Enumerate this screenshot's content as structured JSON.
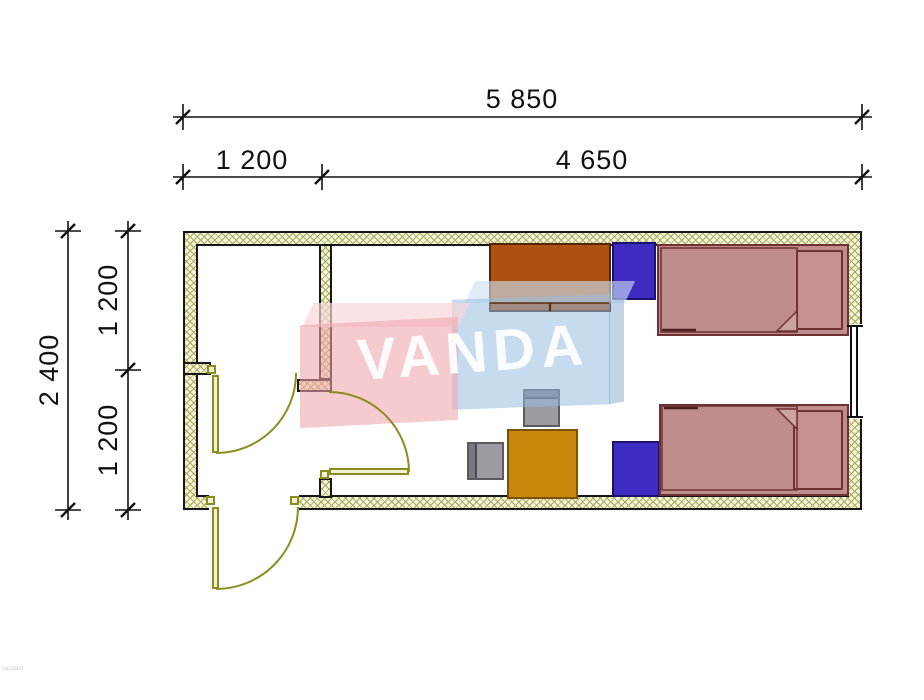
{
  "page": {
    "background": "#ffffff"
  },
  "dimensions": {
    "horizontal": {
      "total": "5 850",
      "segments": [
        "1 200",
        "4 650"
      ]
    },
    "vertical": {
      "total": "2 400",
      "segments": [
        "1 200",
        "1 200"
      ]
    }
  },
  "watermark": {
    "brand": "VANDA",
    "pink": "#f2a3aa",
    "blue": "#96bce0"
  },
  "footer": {
    "note": "vanda.lt"
  },
  "plan": {
    "wall_fill": "#f4f5da",
    "wall_hatch": "#a8a85a",
    "door_color": "#8c8c1e",
    "window_color": "#111111",
    "furniture_colors": {
      "bed": "#c08d8d",
      "bed_outline": "#6e3232",
      "nightstand": "#3d2bc2",
      "wardrobe": "#ad5113",
      "table": "#c8860b",
      "chair": "#9b9ba1"
    }
  }
}
